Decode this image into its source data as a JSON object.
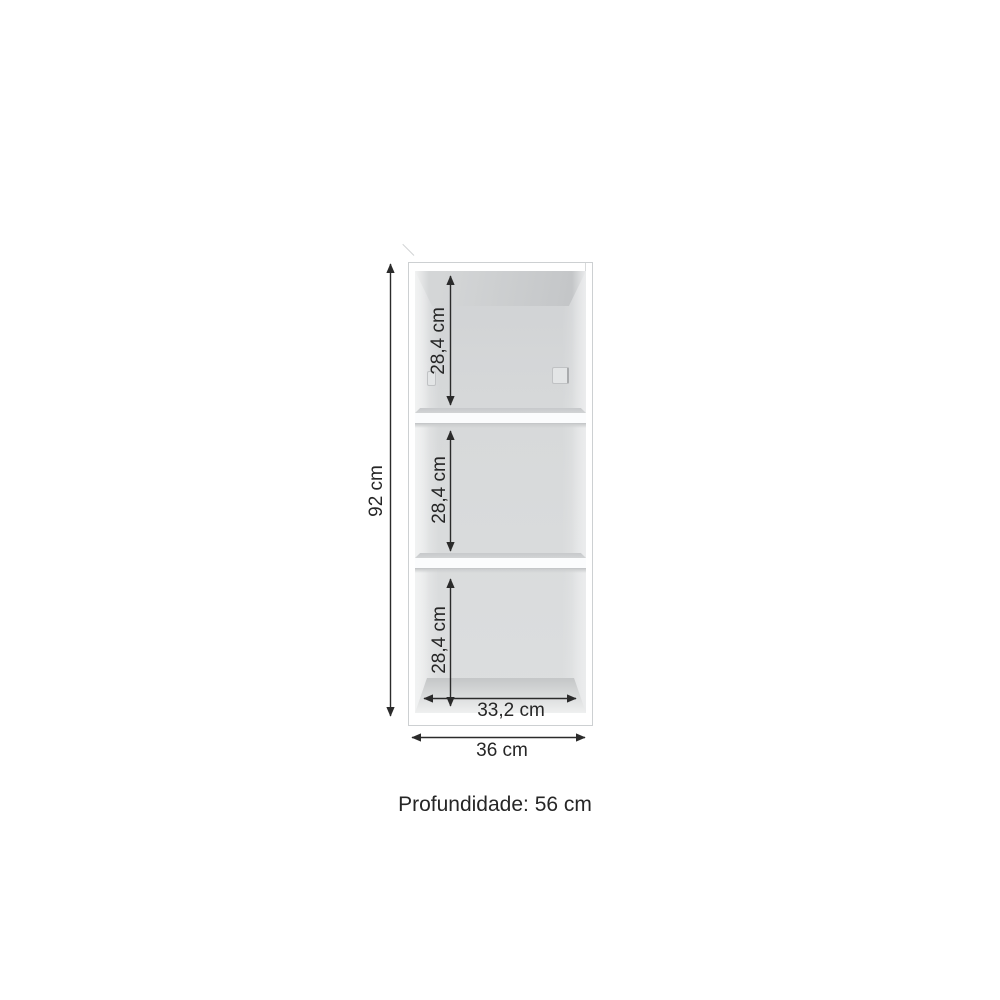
{
  "diagram": {
    "type": "furniture-dimension-diagram",
    "subject": "open cabinet with two shelves and three compartments",
    "labels": {
      "height": "92 cm",
      "compartment_top": "28,4 cm",
      "compartment_middle": "28,4 cm",
      "compartment_bottom": "28,4 cm",
      "inner_width": "33,2 cm",
      "outer_width": "36 cm",
      "depth": "Profundidade: 56 cm"
    },
    "structure": {
      "compartments": 3,
      "shelves": 2,
      "shelf_pins_visible": 2
    },
    "colors": {
      "background": "#ffffff",
      "cabinet_edge": "#cdd0d2",
      "interior_back": "#d7d9da",
      "shelf_front": "#fbfcfd",
      "arrow": "#2b2b2b",
      "dimension_text": "#262626"
    }
  }
}
